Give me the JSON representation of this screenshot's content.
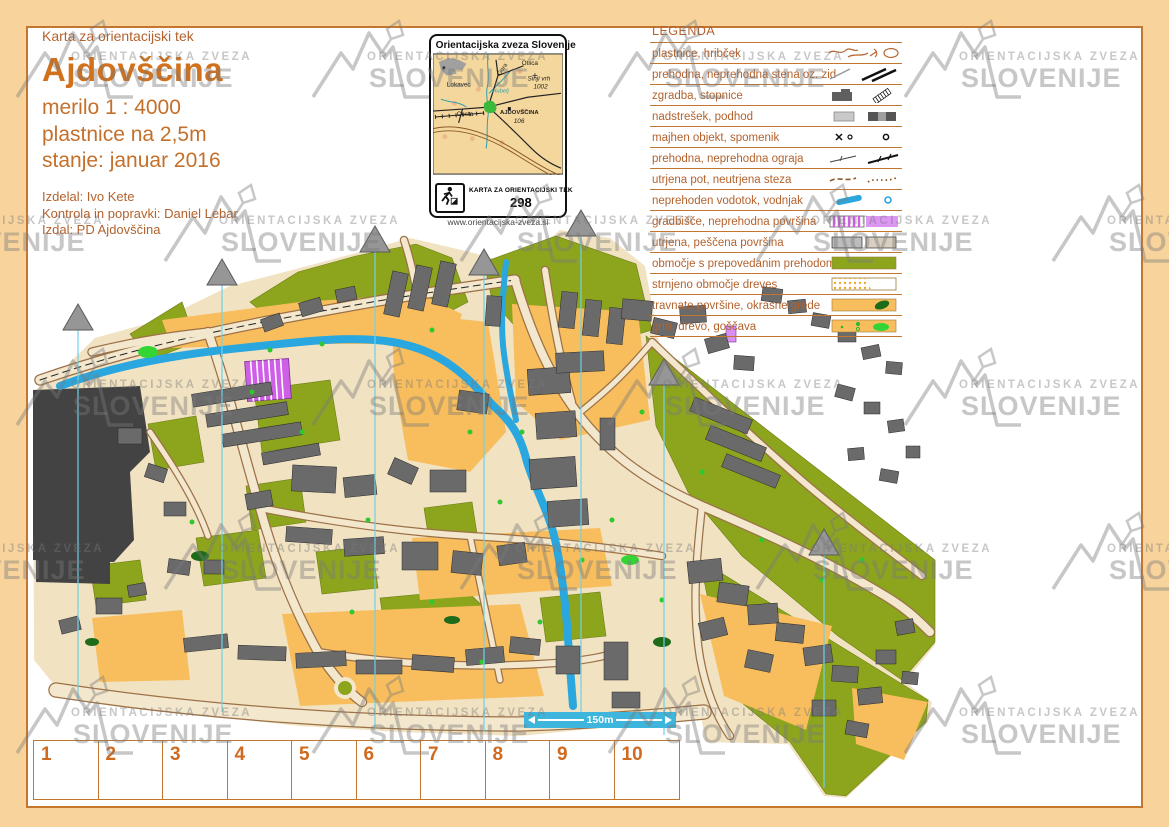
{
  "title_block": {
    "kicker": "Karta za orientacijski tek",
    "title": "Ajdovščina",
    "scale": "merilo 1 : 4000",
    "contours": "plastnice na 2,5m",
    "status": "stanje: januar 2016",
    "credits": [
      "Izdelal: Ivo Kete",
      "Kontrola in popravki: Daniel Lebar",
      "Izdal: PD Ajdovščina"
    ]
  },
  "inset": {
    "header": "Orientacijska zveza Slovenije",
    "labels": {
      "otlica": "Otlica",
      "gora": "Gora",
      "lokavec": "Lokavec",
      "sinji_vrh": "Sinji vrh",
      "elev_1002": "1002",
      "hubelj": "Hubelj",
      "cesta": "Cesta",
      "town": "AJDOVŠČINA",
      "elev_106": "106"
    },
    "footer_label": "KARTA ZA ORIENTACIJSKI TEK",
    "map_number": "298",
    "website": "www.orientacijska-zveza.si"
  },
  "legend": {
    "title": "LEGENDA",
    "items": [
      {
        "label": "plastnice, hribček",
        "icon": "contours-knoll-icon"
      },
      {
        "label": "prehodna, neprehodna stena oz. zid",
        "icon": "wall-icon"
      },
      {
        "label": "zgradba, stopnice",
        "icon": "building-stairs-icon"
      },
      {
        "label": "nadstrešek, podhod",
        "icon": "canopy-underpass-icon"
      },
      {
        "label": "majhen objekt, spomenik",
        "icon": "object-monument-icon"
      },
      {
        "label": "prehodna, neprehodna ograja",
        "icon": "fence-icon"
      },
      {
        "label": "utrjena pot, neutrjena steza",
        "icon": "path-icon"
      },
      {
        "label": "neprehoden vodotok, vodnjak",
        "icon": "water-well-icon"
      },
      {
        "label": "gradbišče, neprehodna površina",
        "icon": "construction-icon"
      },
      {
        "label": "utrjena, peščena površina",
        "icon": "paved-sand-icon"
      },
      {
        "label": "območje s prepovedanim prehodom",
        "icon": "forbidden-area-icon"
      },
      {
        "label": "strnjeno območje dreves",
        "icon": "dense-trees-icon"
      },
      {
        "label": "travnate površine, okrasne grede",
        "icon": "grass-beds-icon"
      },
      {
        "label": "grm, drevo, goščava",
        "icon": "bush-tree-icon"
      }
    ]
  },
  "watermark": {
    "line1": "ORIENTACIJSKA ZVEZA",
    "line2": "SLOVENIJE"
  },
  "scale_bar": {
    "label": "150m"
  },
  "ruler": {
    "numbers": [
      "1",
      "2",
      "3",
      "4",
      "5",
      "6",
      "7",
      "8",
      "9",
      "10"
    ]
  },
  "colors": {
    "frame_peach": "#f8d49c",
    "frame_line": "#c4762f",
    "text_brown": "#b4622d",
    "title_orange": "#d2711c",
    "forbidden_olive": "#8ca51d",
    "open_orange": "#f8be5e",
    "map_beige": "#f1e2c2",
    "road_fill": "#f3e7cd",
    "road_casing": "#9c7148",
    "water_blue": "#2aa7de",
    "building_gray": "#6a6a6a",
    "dark_area": "#434343",
    "north_line_cyan": "#6fd0e8",
    "construction_magenta": "#cf5fe6",
    "scalebar_cyan": "#3eb5dc"
  }
}
